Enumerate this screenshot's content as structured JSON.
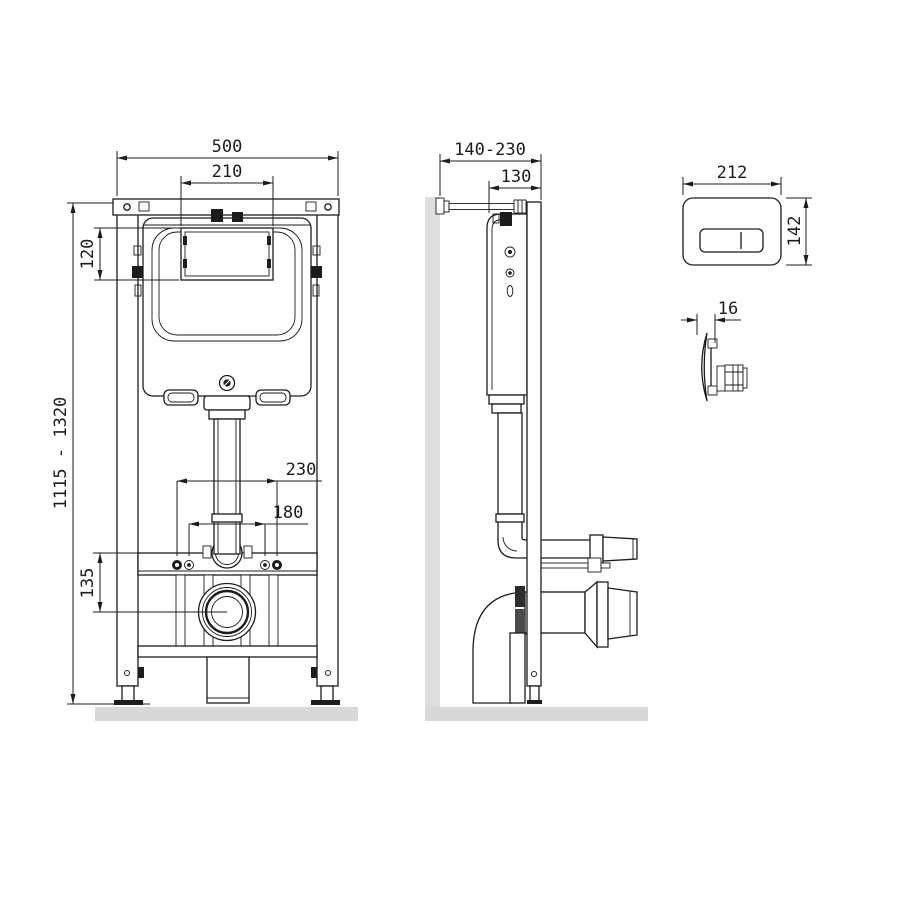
{
  "drawing_type": "wc-concealed-installation-frame-dimension-drawing",
  "labels": {
    "front": {
      "width": "500",
      "window_width": "210",
      "window_height": "120",
      "height_range": "1115 - 1320",
      "fixing_span_outer": "230",
      "fixing_span_inner": "180",
      "outlet_center_offset": "135"
    },
    "side": {
      "wall_offset_range": "140-230",
      "depth": "130"
    },
    "plate": {
      "width": "212",
      "height": "142",
      "thickness": "16"
    }
  },
  "colors": {
    "line": "#1c1c1c",
    "floor": "#d8d8d8",
    "wall": "#dedede",
    "background": "#ffffff"
  }
}
